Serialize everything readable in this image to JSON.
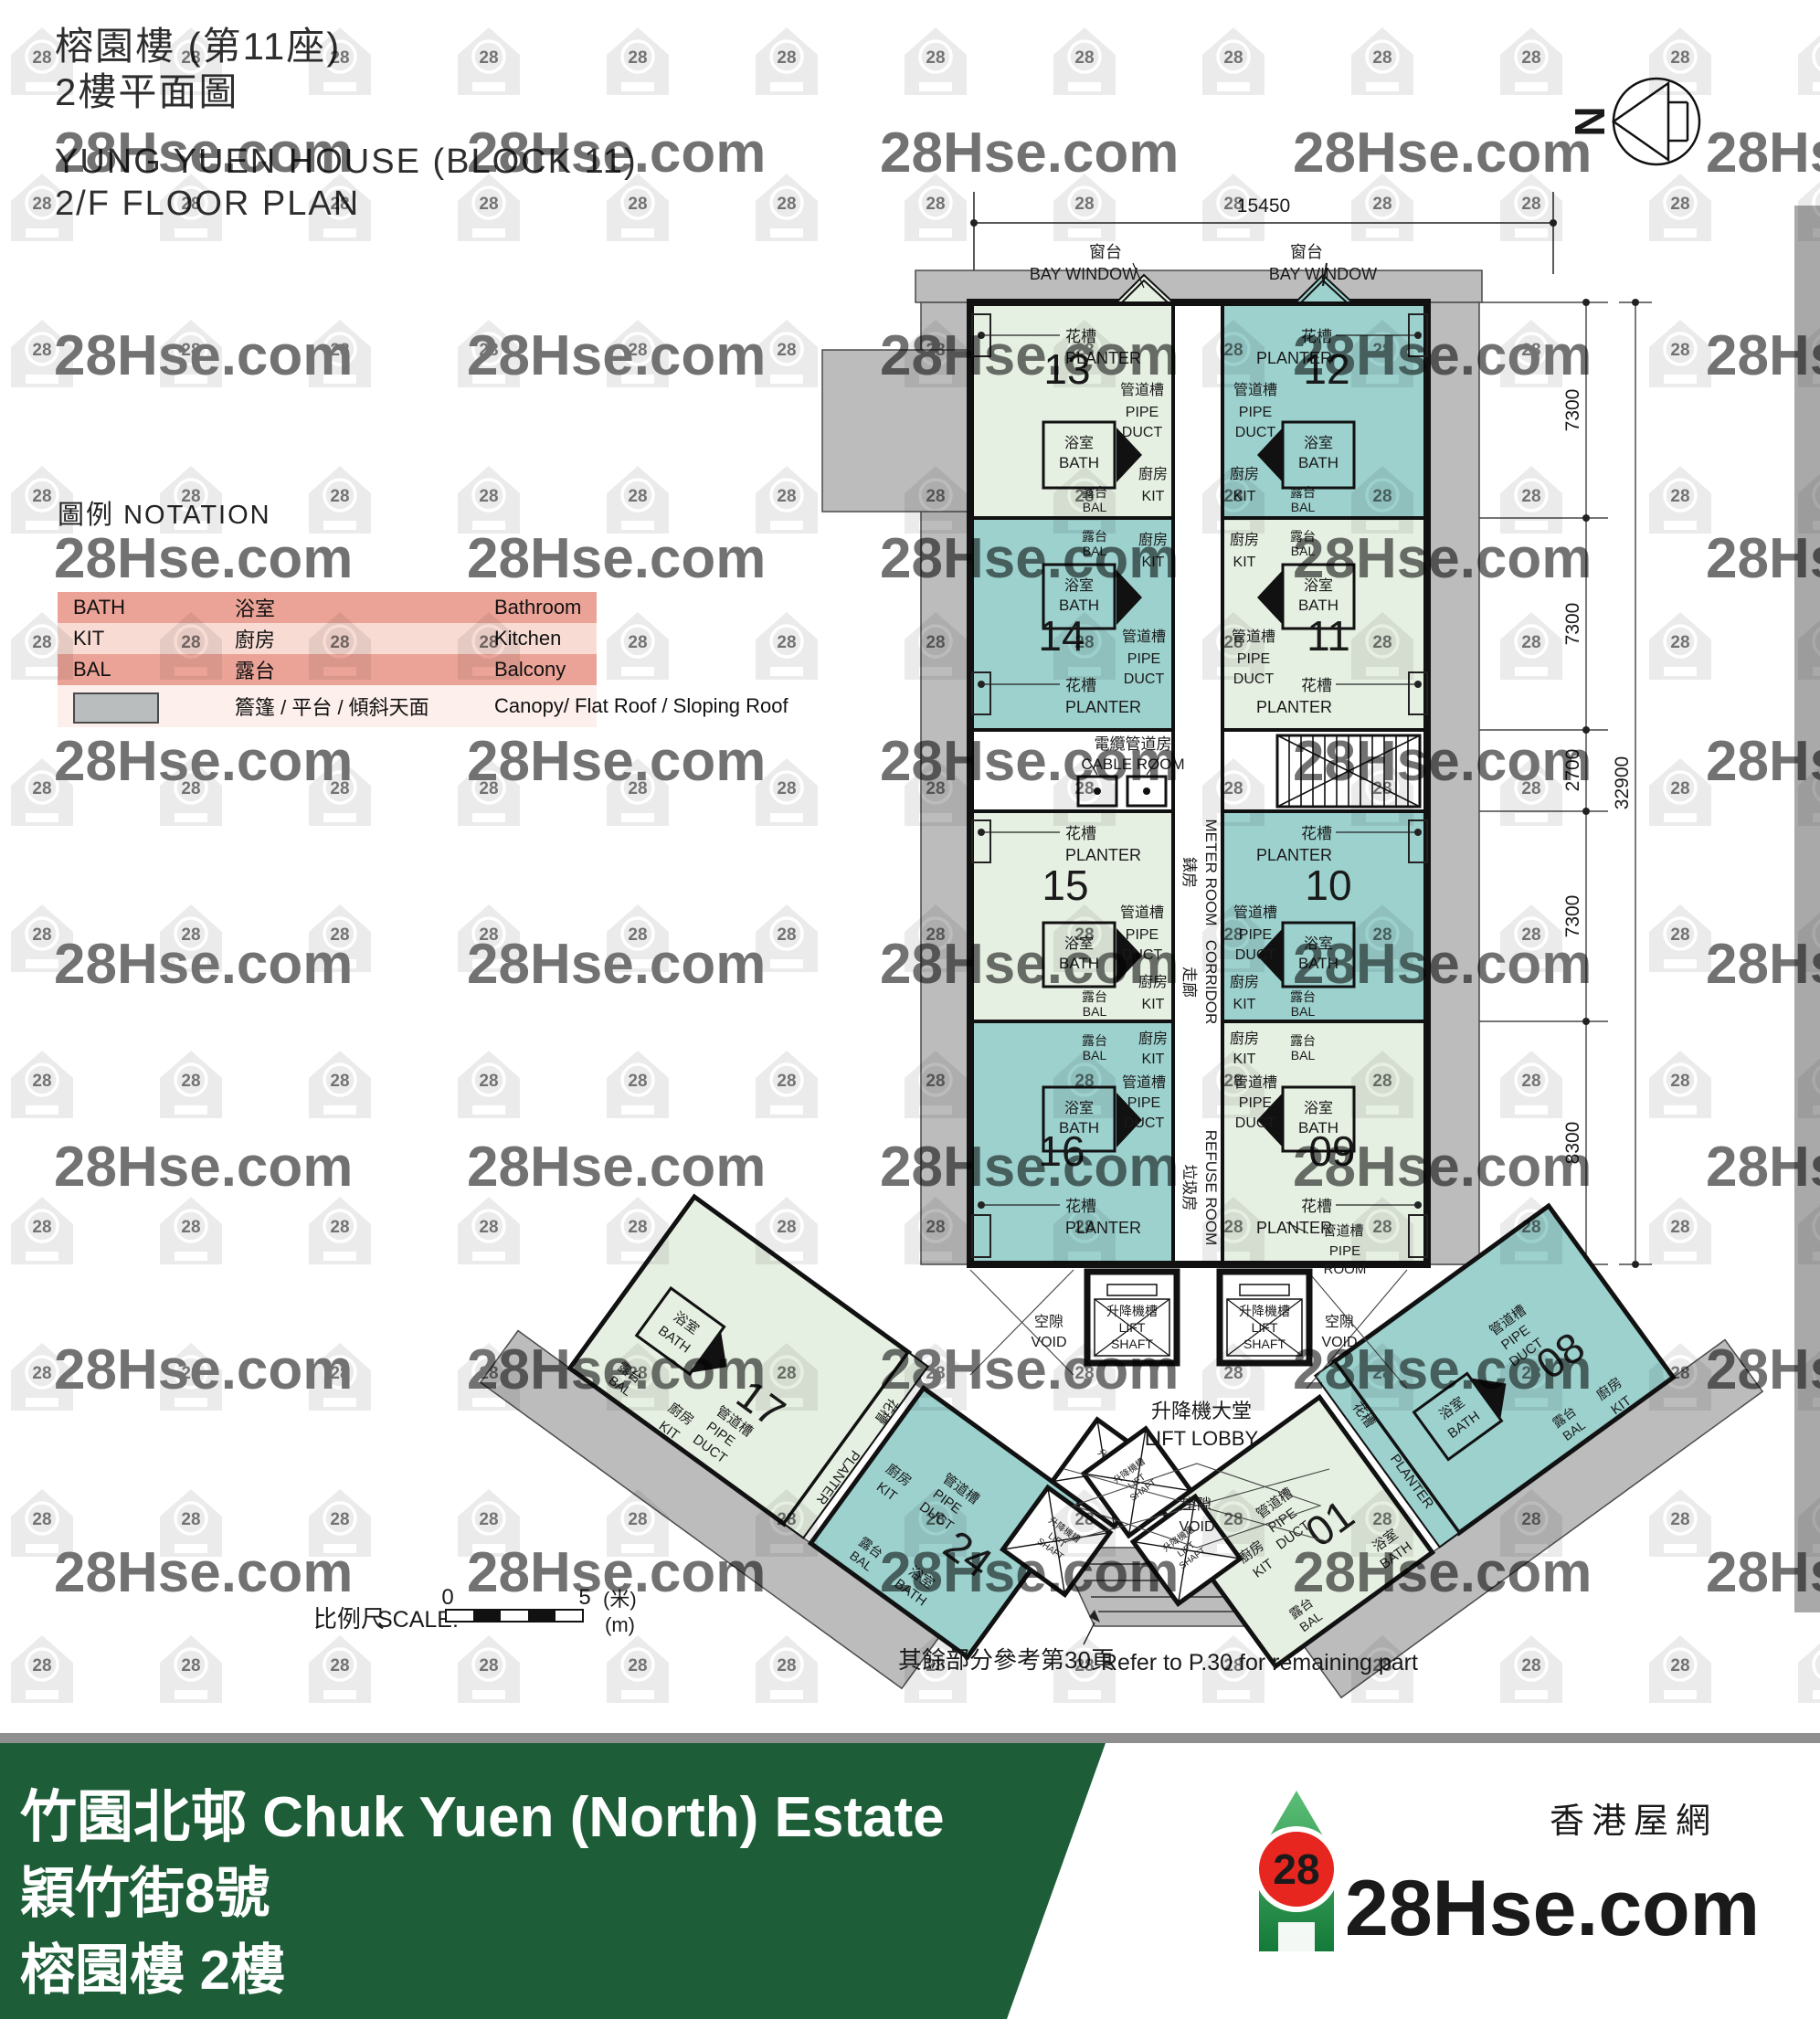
{
  "header": {
    "title_cn": "榕園樓 (第11座)",
    "subtitle_cn": "2樓平面圖",
    "title_en": "YUNG YUEN HOUSE (BLOCK 11)",
    "subtitle_en": "2/F FLOOR PLAN"
  },
  "north": {
    "label": "N"
  },
  "watermark": {
    "site": "28Hse.com",
    "badge": "28"
  },
  "legend": {
    "title_cn": "圖例",
    "title_en": "NOTATION",
    "rows": [
      {
        "abbr": "BATH",
        "cn": "浴室",
        "en": "Bathroom"
      },
      {
        "abbr": "KIT",
        "cn": "廚房",
        "en": "Kitchen"
      },
      {
        "abbr": "BAL",
        "cn": "露台",
        "en": "Balcony"
      },
      {
        "abbr": "",
        "cn": "簷篷 / 平台 / 傾斜天面",
        "en": "Canopy/ Flat Roof / Sloping Roof"
      }
    ]
  },
  "plan": {
    "rooms": {
      "planter_cn": "花槽",
      "planter_en": "PLANTER",
      "bath_cn": "浴室",
      "bath_en": "BATH",
      "kit_cn": "廚房",
      "kit_en": "KIT",
      "bal_cn": "露台",
      "bal_en": "BAL",
      "pipe_cn": "管道槽",
      "pipe_en_1": "PIPE",
      "pipe_en_2": "DUCT"
    },
    "facilities": {
      "bay_cn": "窗台",
      "bay_en": "BAY WINDOW",
      "cable_cn": "電纜管道房",
      "cable_en": "CABLE ROOM",
      "meter_cn": "錶房",
      "meter_en": "METER ROOM",
      "corridor_cn": "走廊",
      "corridor_en": "CORRIDOR",
      "refuse_cn": "垃圾房",
      "refuse_en": "REFUSE ROOM",
      "lift_shaft_cn": "升降機槽",
      "lift_shaft_en_1": "LIFT",
      "lift_shaft_en_2": "SHAFT",
      "lobby_cn": "升降機大堂",
      "lobby_en": "LIFT LOBBY",
      "void_cn": "空隙",
      "void_en": "VOID",
      "pipe_room_cn": "管道槽",
      "pipe_room_en_1": "PIPE",
      "pipe_room_en_2": "ROOM"
    },
    "units": {
      "u13": {
        "number": "13"
      },
      "u12": {
        "number": "12"
      },
      "u14": {
        "number": "14"
      },
      "u11": {
        "number": "11"
      },
      "u15": {
        "number": "15"
      },
      "u10": {
        "number": "10"
      },
      "u16": {
        "number": "16"
      },
      "u09": {
        "number": "09"
      },
      "u17": {
        "number": "17"
      },
      "u08": {
        "number": "08"
      },
      "u24": {
        "number": "24"
      },
      "u01": {
        "number": "01"
      }
    },
    "dimensions": {
      "top": "15450",
      "right_segments": [
        "7300",
        "7300",
        "2700",
        "7300",
        "8300"
      ],
      "right_total": "32900"
    },
    "scale": {
      "label_cn": "比例尺",
      "label_en": "SCALE:",
      "start": "0",
      "end": "5",
      "unit_cn": "(米)",
      "unit_en": "(m)"
    },
    "note": {
      "cn": "其餘部分參考第30頁",
      "en": "Refer to P.30 for remaining part"
    }
  },
  "footer": {
    "estate": "竹園北邨 Chuk Yuen (North) Estate",
    "address": "穎竹街8號",
    "building_floor": "榕園樓 2樓",
    "logo_badge": "28",
    "logo_site": "28Hse.com",
    "logo_site_cn": "香港屋網"
  },
  "colors": {
    "unit_pale": "#e6f0e2",
    "unit_teal": "#9cd1ce",
    "canopy": "#bcbcbc",
    "wall": "#111111",
    "legend_row_dark": "#eca397",
    "legend_row_light": "#f8dcd4",
    "legend_row_faint": "#fdefeb",
    "banner_green": "#1d5e38",
    "logo_red": "#e7261f",
    "watermark_gray": "#d7d7d7"
  }
}
